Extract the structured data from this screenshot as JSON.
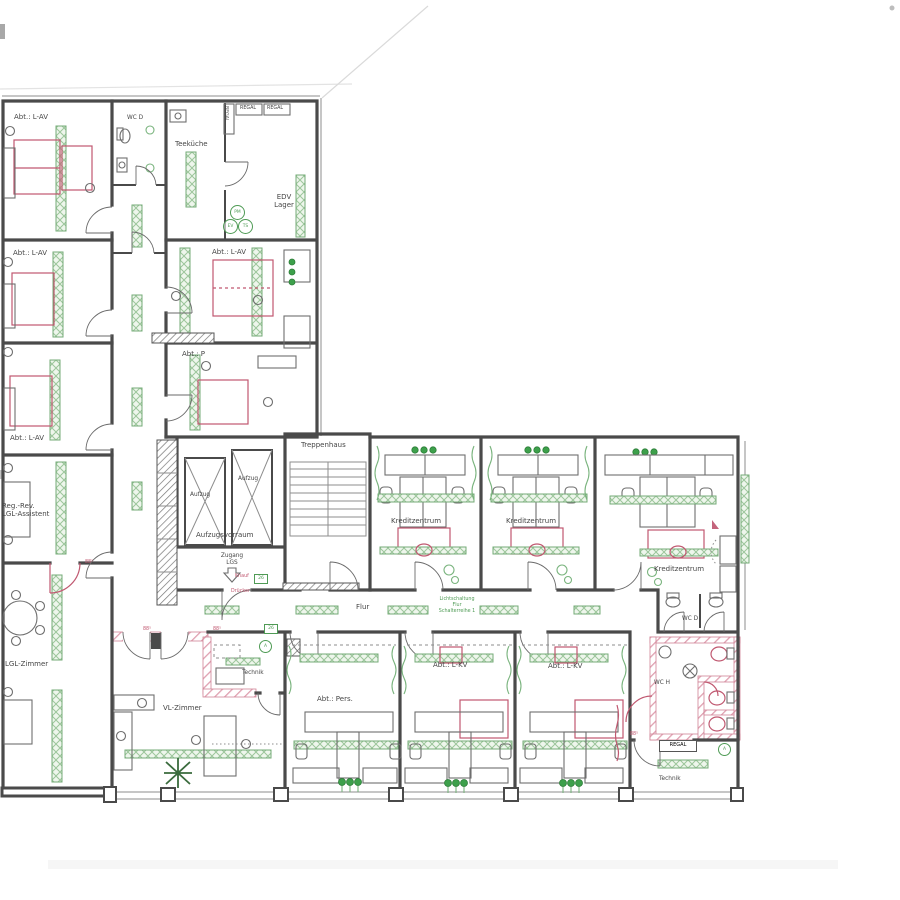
{
  "colors": {
    "wall": "#4a4a4a",
    "ink": "#454545",
    "green": "#4f9b55",
    "green_fill": "#e9f3e7",
    "red": "#c05870",
    "paper": "#ffffff"
  },
  "labels": {
    "abt_lav_1": "Abt.: L-AV",
    "wc_d_top": "WC D",
    "teekueche": "Teeküche",
    "regal_v": "REGAL",
    "regal_1": "REGAL",
    "regal_2": "REGAL",
    "edv_lager": "EDV\nLager",
    "abt_lav_2": "Abt.: L-AV",
    "abt_lav_3": "Abt.: L-AV",
    "abt_p": "Abt.: P",
    "abt_lav_4": "Abt.: L-AV",
    "treppenhaus": "Treppenhaus",
    "aufzug_1": "Aufzug",
    "aufzug_2": "Aufzug",
    "aufzugsvorraum": "Aufzugsvorraum",
    "zugang_lgs": "Zugang\nLGS",
    "knauf": "Knauf",
    "druecker": "Drücker",
    "box26_a": "26",
    "box26_b": "26",
    "reg_rev": "Reg.-Rev.\nLGL-Assistent",
    "lgl_zimmer": "LGL-Zimmer",
    "vl_zimmer": "VL-Zimmer",
    "technik_mitte": "Technik",
    "abt_pers": "Abt.: Pers.",
    "abt_lkv_1": "Abt.: L-KV",
    "abt_lkv_2": "Abt.: L-KV",
    "kreditzentrum_1": "Kreditzentrum",
    "kreditzentrum_2": "Kreditzentrum",
    "kreditzentrum_3": "Kreditzentrum",
    "flur": "Flur",
    "lichtschaltung": "Lichtschaltung\nFlur\nSchalterreihe 1",
    "wc_d_rechts": "WC D",
    "wc_h": "WC H",
    "regal_3": "REGAL",
    "technik_rechts": "Technik",
    "dim_885_1": "88⁵",
    "dim_885_2": "88⁵",
    "dim_885_3": "88⁵",
    "dim_885_4": "88⁵",
    "pm": "PM",
    "ev": "EV",
    "ts": "TS",
    "a_1": "A",
    "a_2": "A"
  }
}
